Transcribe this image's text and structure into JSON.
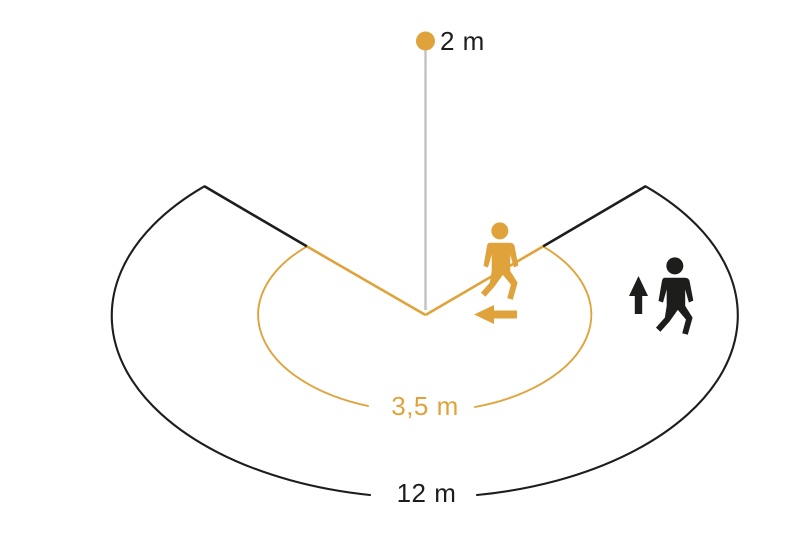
{
  "diagram": {
    "background": "#FFFFFF",
    "sensor": {
      "height_label": "2 m",
      "dot_color": "#E0A33C",
      "pole_color": "#C1C1C1",
      "label_color": "#1D1D1B"
    },
    "zones": {
      "inner": {
        "label": "3,5 m",
        "color": "#E0A33C"
      },
      "outer": {
        "label": "12 m",
        "color": "#1D1D1B"
      }
    },
    "figures": {
      "crossing_walker_color": "#E0A33C",
      "approaching_walker_color": "#1D1D1B"
    }
  }
}
